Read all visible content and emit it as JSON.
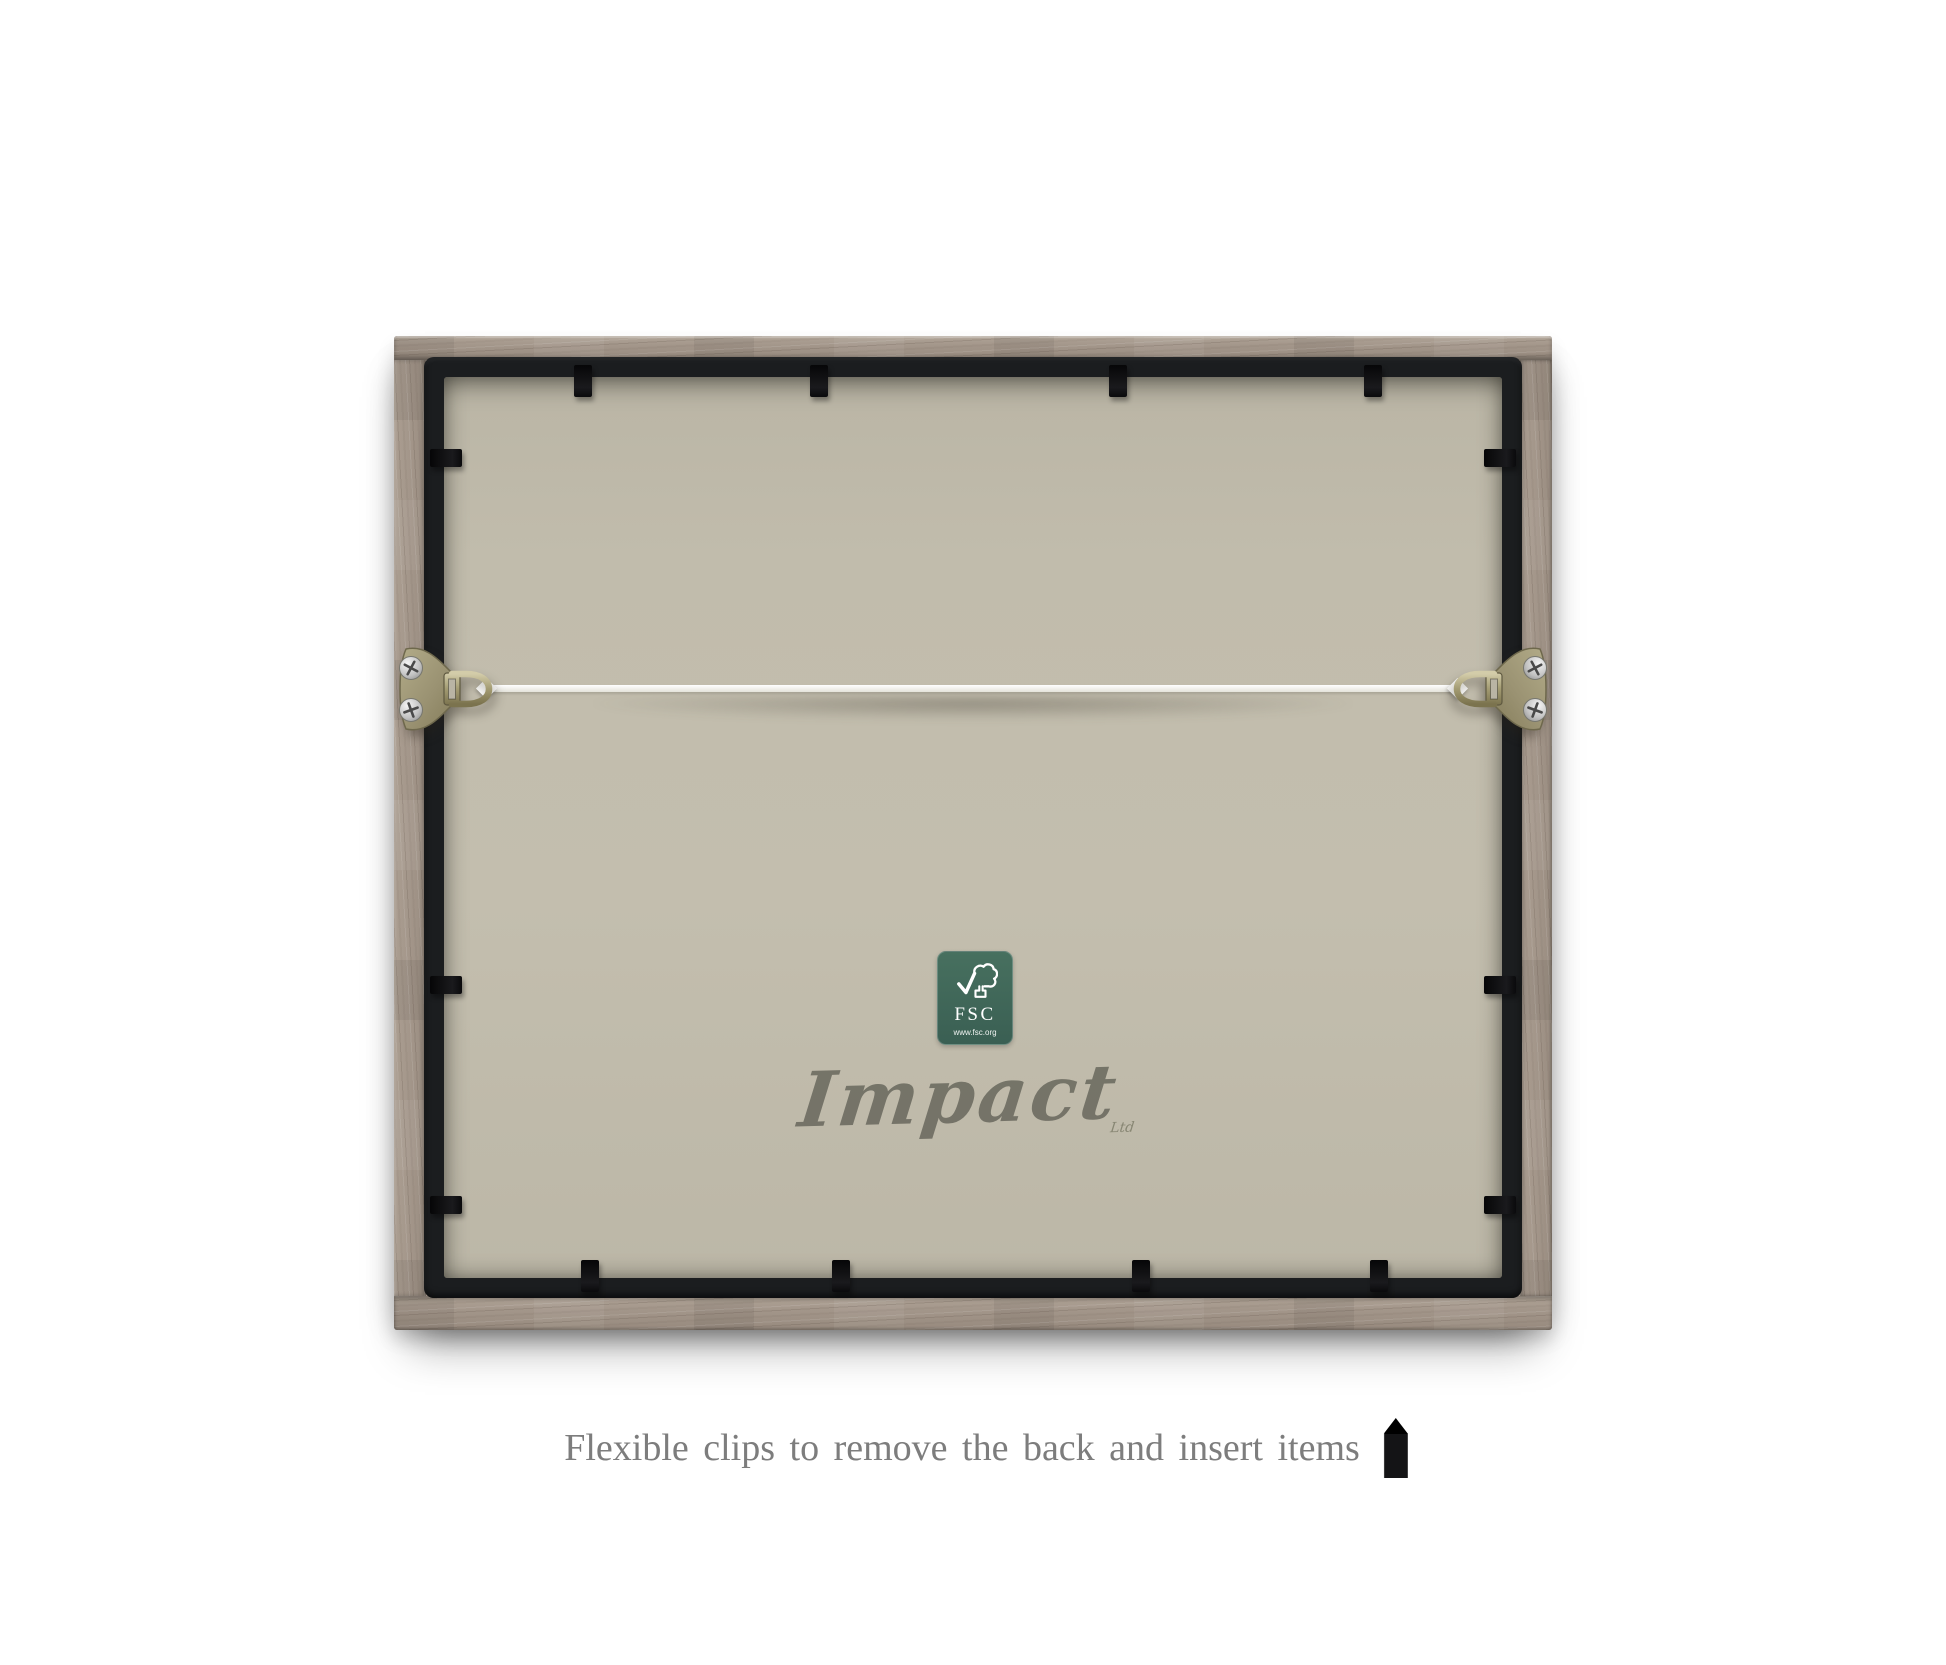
{
  "caption": {
    "text": "Flexible clips to remove the back and insert items",
    "color": "#7d7d7d",
    "icon": "clip-icon"
  },
  "brand": {
    "name": "Impact",
    "suffix": "Ltd",
    "color": "#6f6e63"
  },
  "fsc_label": {
    "title": "FSC",
    "url": "www.fsc.org",
    "background": "#3d655a",
    "icon": "fsc-tree-checkmark-icon"
  },
  "frame": {
    "wood_color": "#a3968a",
    "inner_frame_color": "#1b1d1f",
    "backing_color": "#c1bcac",
    "clip_color": "#0f0f11",
    "cord_color": "#f7f7f4",
    "hanger_color": "#a09a77",
    "screw_color": "#c9c9c9",
    "clips": {
      "top": 4,
      "bottom": 4,
      "left": 3,
      "right": 3
    },
    "hangers": 2
  }
}
